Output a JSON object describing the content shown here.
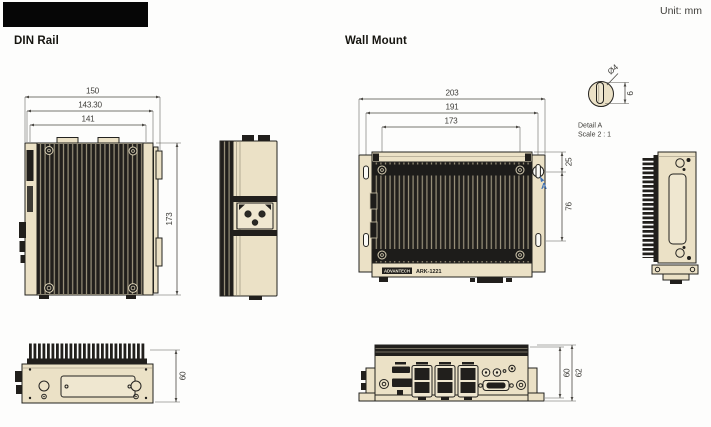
{
  "page": {
    "unit_label": "Unit: mm"
  },
  "din_rail": {
    "heading": "DIN Rail",
    "front_view": {
      "width_overall": "150",
      "width_mid": "143.30",
      "width_inner": "141",
      "height": "173"
    },
    "bottom_view": {
      "height": "60"
    }
  },
  "wall_mount": {
    "heading": "Wall Mount",
    "front_view": {
      "width_overall": "203",
      "width_mounting_slots": "191",
      "width_screws": "173",
      "slot_offset_top": "25",
      "slot_spacing": "76",
      "detail_ref": "A"
    },
    "detail_a": {
      "title": "Detail A",
      "scale": "Scale 2 : 1",
      "hole_diameter": "Ø4",
      "slot_length": "6"
    },
    "bottom_view": {
      "height_body": "60",
      "height_overall": "62"
    },
    "device_label": {
      "brand": "ADVANTECH",
      "model": "ARK-1221"
    }
  },
  "colors": {
    "chassis_beige": "#EBE1C6",
    "fin_black": "#211F1C",
    "detail_blue": "#3C6EB4"
  }
}
